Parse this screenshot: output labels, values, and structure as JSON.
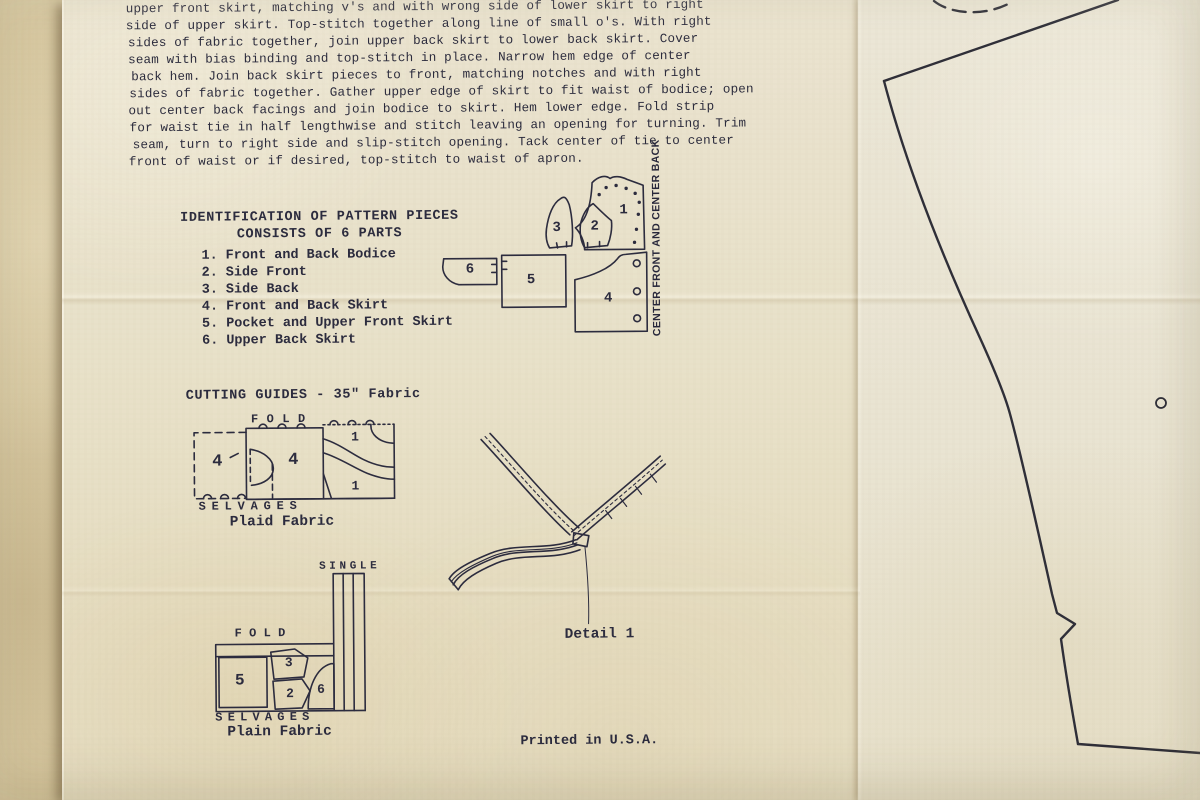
{
  "colors": {
    "ink": "#2b2b3e",
    "paper": "#e8e1c9",
    "tissue": "#eae5d4",
    "backdrop": "#d2c199"
  },
  "instructions": {
    "lines": [
      "upper front skirt, matching v's and with wrong side of lower skirt to right",
      "side of upper skirt. Top-stitch together along line of small o's. With right",
      "sides of fabric together, join upper back skirt to lower back skirt. Cover",
      "seam with bias binding and top-stitch in place. Narrow hem edge of center",
      "back hem. Join back skirt pieces to front, matching notches and with right",
      "sides of fabric together. Gather upper edge of skirt to fit waist of bodice; open",
      "out center back facings and join bodice to skirt. Hem lower edge. Fold strip",
      "for waist tie in half lengthwise and stitch leaving an opening for turning. Trim",
      "seam, turn to right side and slip-stitch opening. Tack center of tie to center",
      "front of waist or if desired, top-stitch to waist of apron."
    ]
  },
  "identification": {
    "title": "IDENTIFICATION OF PATTERN PIECES",
    "subtitle": "CONSISTS OF 6 PARTS",
    "items": [
      {
        "num": "1.",
        "label": "Front and Back Bodice"
      },
      {
        "num": "2.",
        "label": "Side Front"
      },
      {
        "num": "3.",
        "label": "Side Back"
      },
      {
        "num": "4.",
        "label": "Front and Back Skirt"
      },
      {
        "num": "5.",
        "label": "Pocket and Upper Front Skirt"
      },
      {
        "num": "6.",
        "label": "Upper Back Skirt"
      }
    ]
  },
  "pieces_diagram": {
    "center_axis_label": "CENTER FRONT AND CENTER BACK",
    "labels": {
      "p1": "1",
      "p2": "2",
      "p3": "3",
      "p4": "4",
      "p5": "5",
      "p6": "6"
    }
  },
  "cutting_guides": {
    "heading": "CUTTING GUIDES - 35\" Fabric",
    "plaid": {
      "fold": "FOLD",
      "selvages": "SELVAGES",
      "caption": "Plaid Fabric",
      "label_4a": "4",
      "label_4b": "4",
      "label_1a": "1",
      "label_1b": "1"
    },
    "plain": {
      "single": "SINGLE",
      "fold": "FOLD",
      "selvages": "SELVAGES",
      "caption": "Plain Fabric",
      "label_5": "5",
      "label_3": "3",
      "label_2": "2",
      "label_6": "6"
    }
  },
  "detail_1": {
    "caption": "Detail 1"
  },
  "footer": {
    "printed_in": "Printed in U.S.A."
  }
}
